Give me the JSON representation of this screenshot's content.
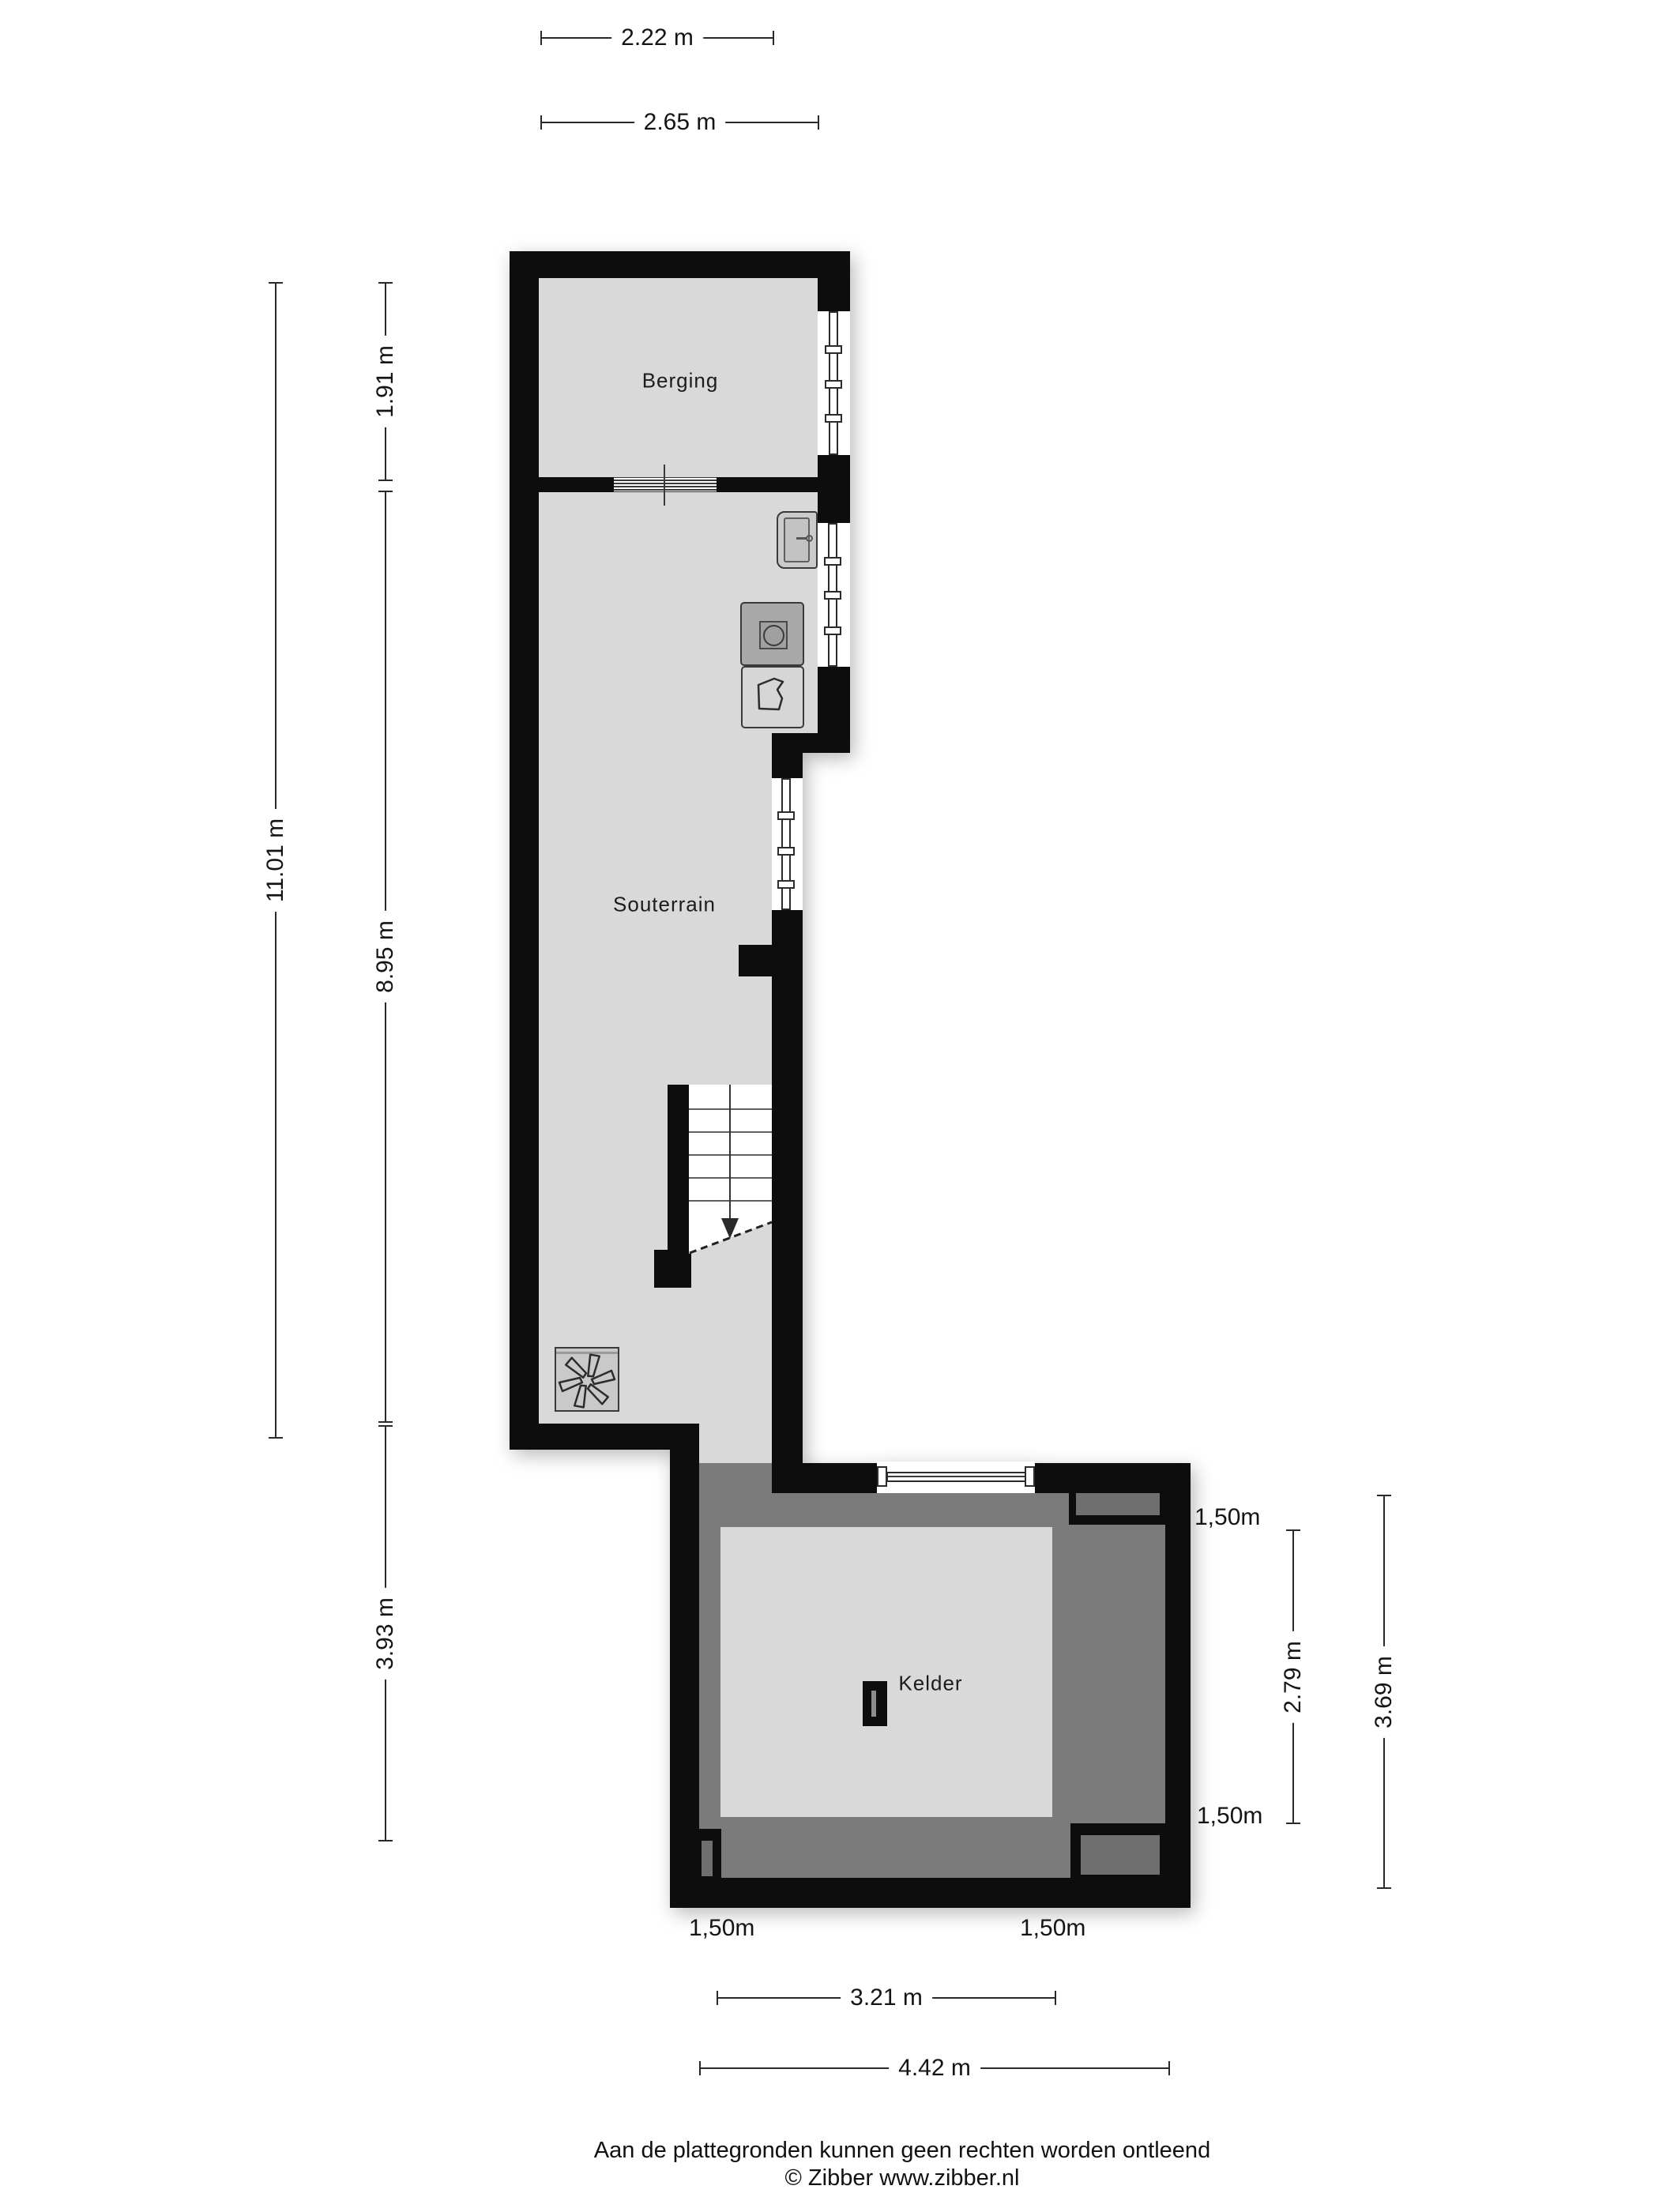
{
  "rooms": {
    "berging": "Berging",
    "souterrain": "Souterrain",
    "kelder": "Kelder"
  },
  "dimensions": {
    "top_width_small": "2.22 m",
    "top_width_large": "2.65 m",
    "left_total_height": "11.01 m",
    "left_berging_depth": "1.91 m",
    "left_souterrain_depth": "8.95 m",
    "left_kelder_depth": "3.93 m",
    "right_kelder_inner_height": "2.79 m",
    "right_kelder_outer_height": "3.69 m",
    "bottom_kelder_inner_width": "3.21 m",
    "bottom_kelder_outer_width": "4.42 m"
  },
  "offsets": {
    "right_top": "1,50m",
    "right_bottom": "1,50m",
    "bottom_left": "1,50m",
    "bottom_right": "1,50m"
  },
  "footer": {
    "disclaimer": "Aan de plattegronden kunnen geen rechten worden ontleend",
    "copyright": "© Zibber www.zibber.nl"
  },
  "colors": {
    "wall": "#0d0d0d",
    "floor_light": "#d9d9d9",
    "floor_dark": "#7b7b7b",
    "niche": "#6f6f6f",
    "background": "#ffffff"
  }
}
